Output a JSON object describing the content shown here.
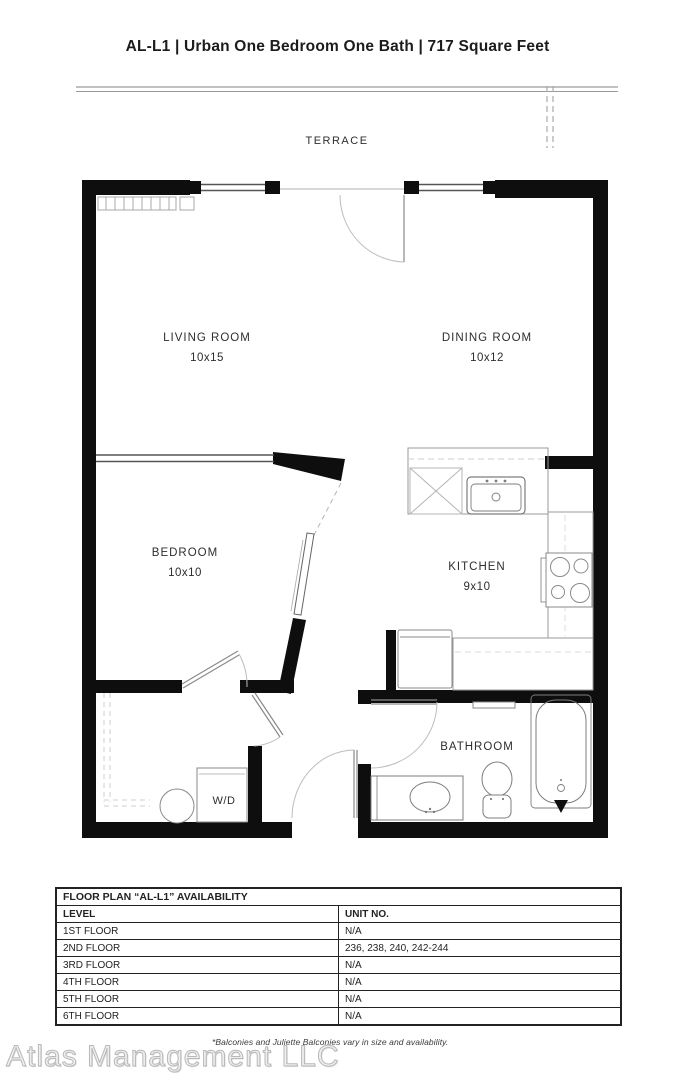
{
  "title": "AL-L1 | Urban One Bedroom One Bath | 717 Square Feet",
  "plan": {
    "terrace_label": "TERRACE",
    "rooms": [
      {
        "name": "LIVING ROOM",
        "dims": "10x15"
      },
      {
        "name": "DINING ROOM",
        "dims": "10x12"
      },
      {
        "name": "BEDROOM",
        "dims": "10x10"
      },
      {
        "name": "KITCHEN",
        "dims": "9x10"
      },
      {
        "name": "BATHROOM",
        "dims": ""
      },
      {
        "name": "W/D",
        "dims": ""
      }
    ]
  },
  "availability_table": {
    "title": "FLOOR PLAN “AL-L1” AVAILABILITY",
    "columns": [
      "LEVEL",
      "UNIT NO."
    ],
    "rows": [
      {
        "level": "1ST FLOOR",
        "units": "N/A"
      },
      {
        "level": "2ND FLOOR",
        "units": "236, 238, 240, 242-244"
      },
      {
        "level": "3RD FLOOR",
        "units": "N/A"
      },
      {
        "level": "4TH FLOOR",
        "units": "N/A"
      },
      {
        "level": "5TH FLOOR",
        "units": "N/A"
      },
      {
        "level": "6TH FLOOR",
        "units": "N/A"
      }
    ]
  },
  "footnote": "*Balconies and Juliette Balconies vary in size and availability.",
  "watermark": "Atlas Management LLC",
  "colors": {
    "wall": "#0e0e0e",
    "fixture_line": "#8a8a8a",
    "light_line": "#c2c2c2",
    "text": "#2e2e2e"
  }
}
